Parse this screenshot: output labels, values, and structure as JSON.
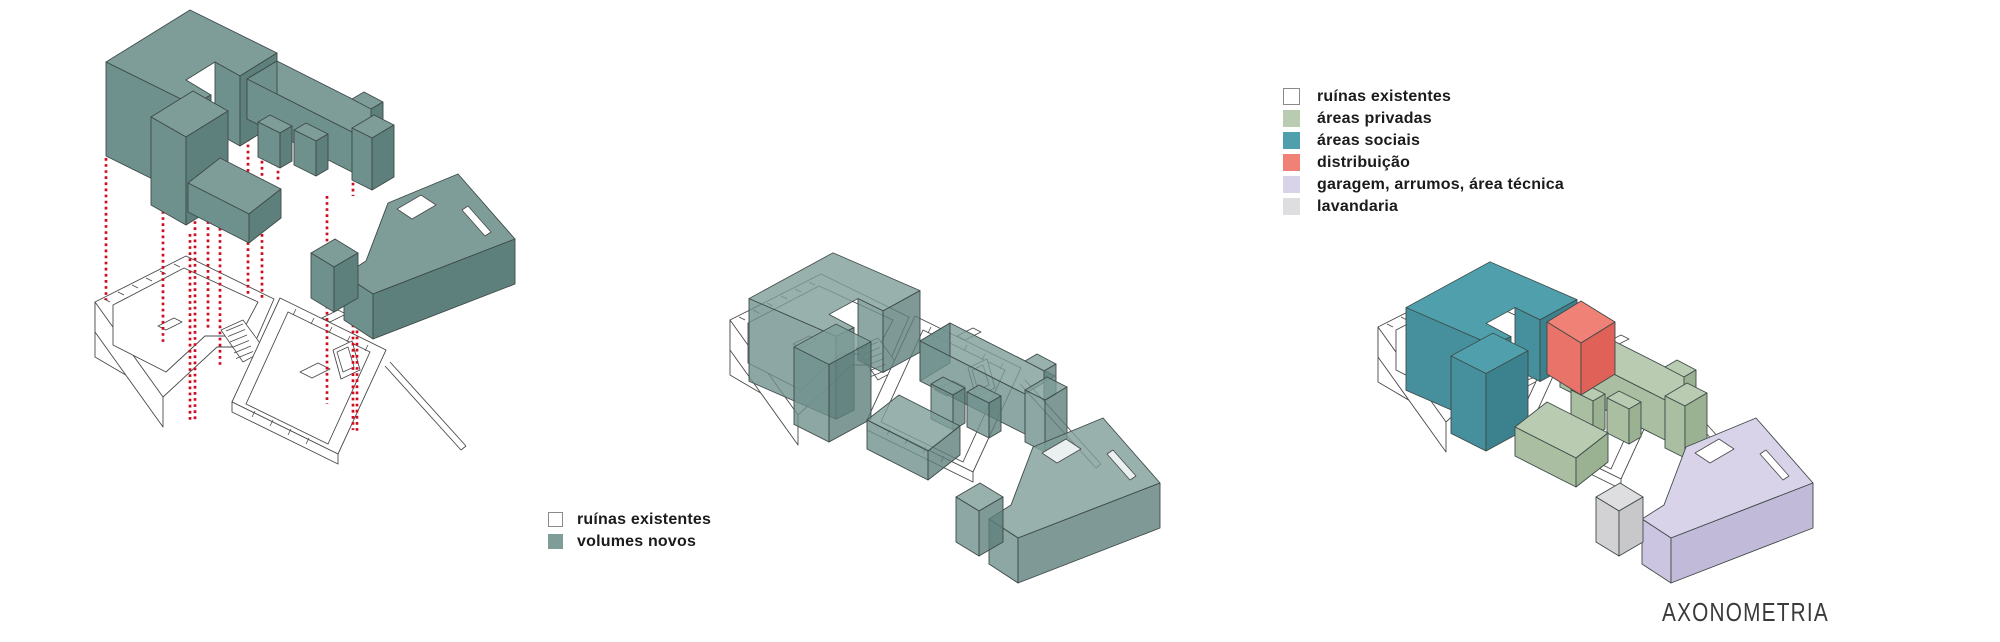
{
  "title": {
    "label": "AXONOMETRIA"
  },
  "legend_left": {
    "items": [
      {
        "key": "ruinas",
        "label": "ruínas existentes"
      },
      {
        "key": "volumes",
        "label": "volumes novos"
      }
    ]
  },
  "legend_right": {
    "items": [
      {
        "key": "ruinas",
        "label": "ruínas existentes"
      },
      {
        "key": "privadas",
        "label": "áreas privadas"
      },
      {
        "key": "sociais",
        "label": "áreas sociais"
      },
      {
        "key": "distribuicao",
        "label": "distribuição"
      },
      {
        "key": "garagem",
        "label": "garagem, arrumos, área técnica"
      },
      {
        "key": "lavandaria",
        "label": "lavandaria"
      }
    ]
  },
  "colors": {
    "volume_top": "#7E9D99",
    "volume_left": "#6F918D",
    "volume_right": "#5E807C",
    "social_top": "#4FA0AC",
    "social_left": "#45909C",
    "social_right": "#3B828E",
    "privadas_top": "#B9CBB1",
    "privadas_left": "#AABFA1",
    "privadas_right": "#9BB292",
    "distrib_top": "#EF8177",
    "distrib_left": "#E97368",
    "distrib_right": "#E06158",
    "garagem_top": "#D9D3EA",
    "garagem_left": "#CCC5E1",
    "garagem_right": "#C2BAD9",
    "lavandaria_top": "#DEDEE0",
    "lavandaria_left": "#D2D2D4",
    "lavandaria_right": "#C8C8CA",
    "projection_red": "#CE0E1E",
    "ruin_stroke": "#4A4A4A",
    "volume_stroke": "#3E4A48",
    "legend_ruinas_border": "#8A8A8A",
    "text": "#1B1B1B",
    "title_text": "#3A3A3A"
  }
}
